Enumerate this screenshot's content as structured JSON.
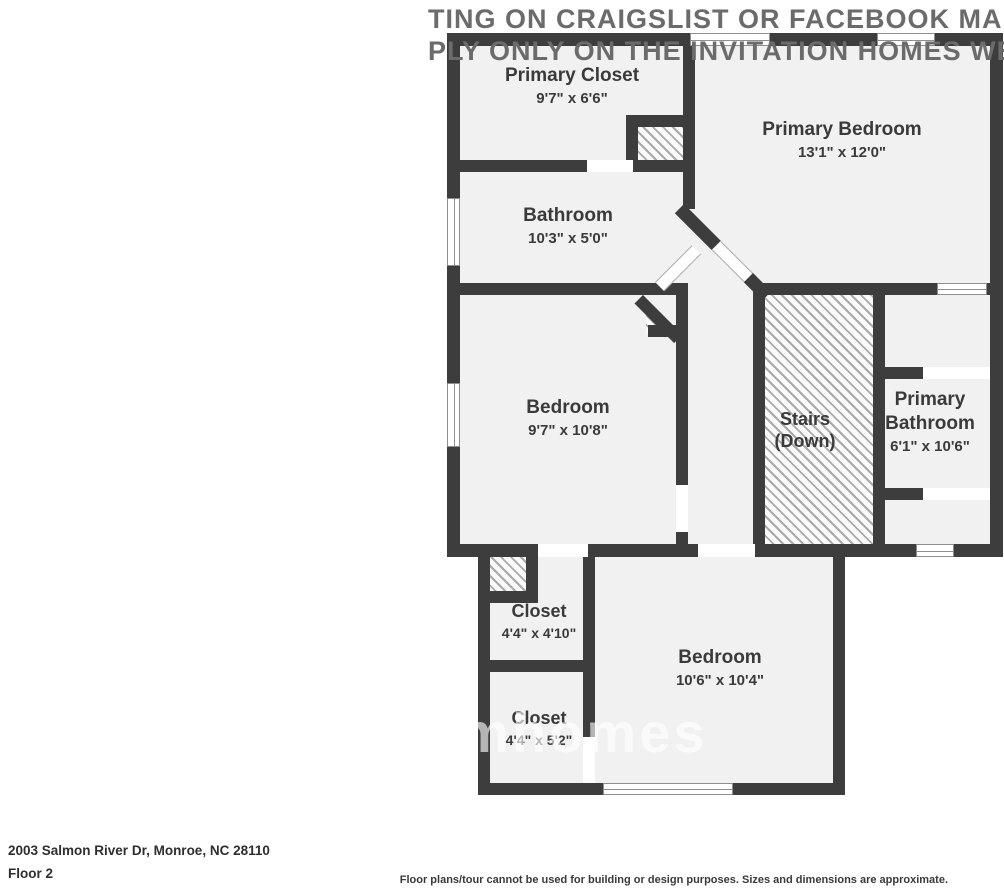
{
  "watermark": {
    "top_line1": "TING ON CRAIGSLIST OR FACEBOOK MARKET",
    "top_line2": "PLY ONLY ON THE INVITATION HOMES WEBSIT",
    "center_fragment": "omhomes"
  },
  "floorplan": {
    "rooms": [
      {
        "name": "Primary Closet",
        "dims": "9'7\" x 6'6\""
      },
      {
        "name": "Primary Bedroom",
        "dims": "13'1\" x 12'0\""
      },
      {
        "name": "Bathroom",
        "dims": "10'3\" x 5'0\""
      },
      {
        "name": "Bedroom",
        "dims": "9'7\" x 10'8\""
      },
      {
        "name": "Stairs",
        "dims": "(Down)"
      },
      {
        "name": "Primary Bathroom",
        "dims": "6'1\" x 10'6\""
      },
      {
        "name": "Closet",
        "dims": "4'4\" x 4'10\""
      },
      {
        "name": "Closet",
        "dims": "4'4\" x 5'2\""
      },
      {
        "name": "Bedroom",
        "dims": "10'6\" x 10'4\""
      }
    ]
  },
  "footer": {
    "address": "2003 Salmon River Dr, Monroe, NC 28110",
    "floor_label": "Floor 2",
    "disclaimer": "Floor plans/tour cannot be used for building or design purposes. Sizes and dimensions are approximate."
  },
  "colors": {
    "wall": "#3d3d3d",
    "floor": "#f1f1f1",
    "hatch_line": "#a9a9a9",
    "watermark_top": "#6b6b6b",
    "label_text": "#3a3a3a"
  }
}
